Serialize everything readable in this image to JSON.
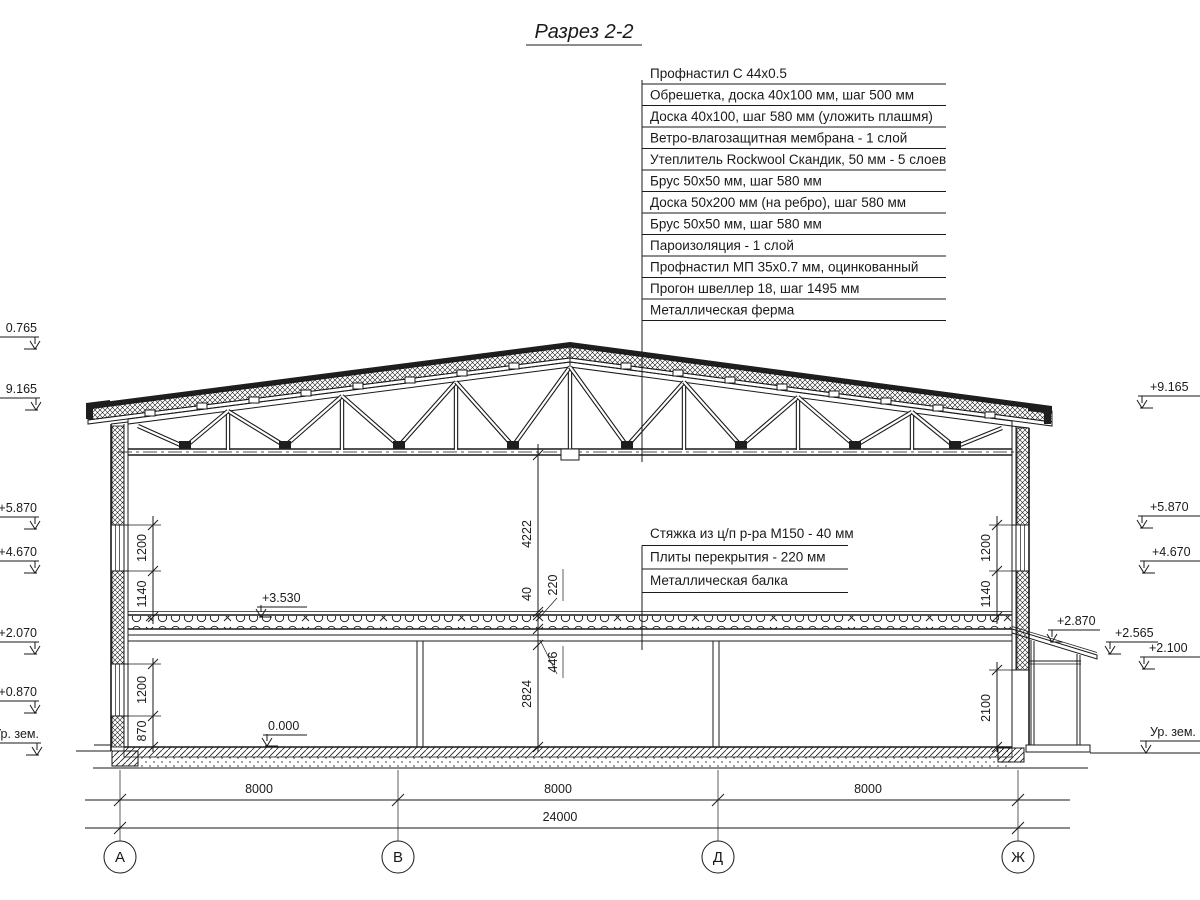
{
  "title": "Разрез 2-2",
  "roof_callouts": [
    "Профнастил С 44х0.5",
    "Обрешетка, доска 40х100 мм, шаг 500 мм",
    "Доска 40х100, шаг 580 мм (уложить плашмя)",
    "Ветро-влагозащитная мембрана - 1 слой",
    "Утеплитель Rockwool Скандик, 50 мм - 5 слоев",
    "Брус 50х50 мм, шаг 580 мм",
    "Доска 50х200 мм (на ребро), шаг 580 мм",
    "Брус 50х50 мм, шаг 580 мм",
    "Пароизоляция - 1 слой",
    "Профнастил МП 35х0.7 мм, оцинкованный",
    "Прогон швеллер 18, шаг 1495 мм",
    "Металлическая ферма"
  ],
  "floor_callouts": [
    "Стяжка из ц/п р-ра М150 - 40 мм",
    "Плиты перекрытия - 220 мм",
    "Металлическая балка"
  ],
  "elev_left": [
    "0.765",
    "9.165",
    "+5.870",
    "+4.670",
    "+2.070",
    "+0.870",
    "Ур. зем."
  ],
  "elev_right": [
    "+9.165",
    "+5.870",
    "+4.670",
    "+2.870",
    "+2.565",
    "+2.100",
    "Ур. зем."
  ],
  "elev_inner": [
    "+3.530",
    "0.000"
  ],
  "dims_center": [
    "4222",
    "40",
    "220",
    "446",
    "2824"
  ],
  "dims_left": [
    "1200",
    "1140",
    "1200",
    "870"
  ],
  "dims_right": [
    "1200",
    "1140",
    "2100"
  ],
  "dims_bottom": [
    "8000",
    "8000",
    "8000",
    "24000"
  ],
  "axes": [
    "А",
    "В",
    "Д",
    "Ж"
  ]
}
